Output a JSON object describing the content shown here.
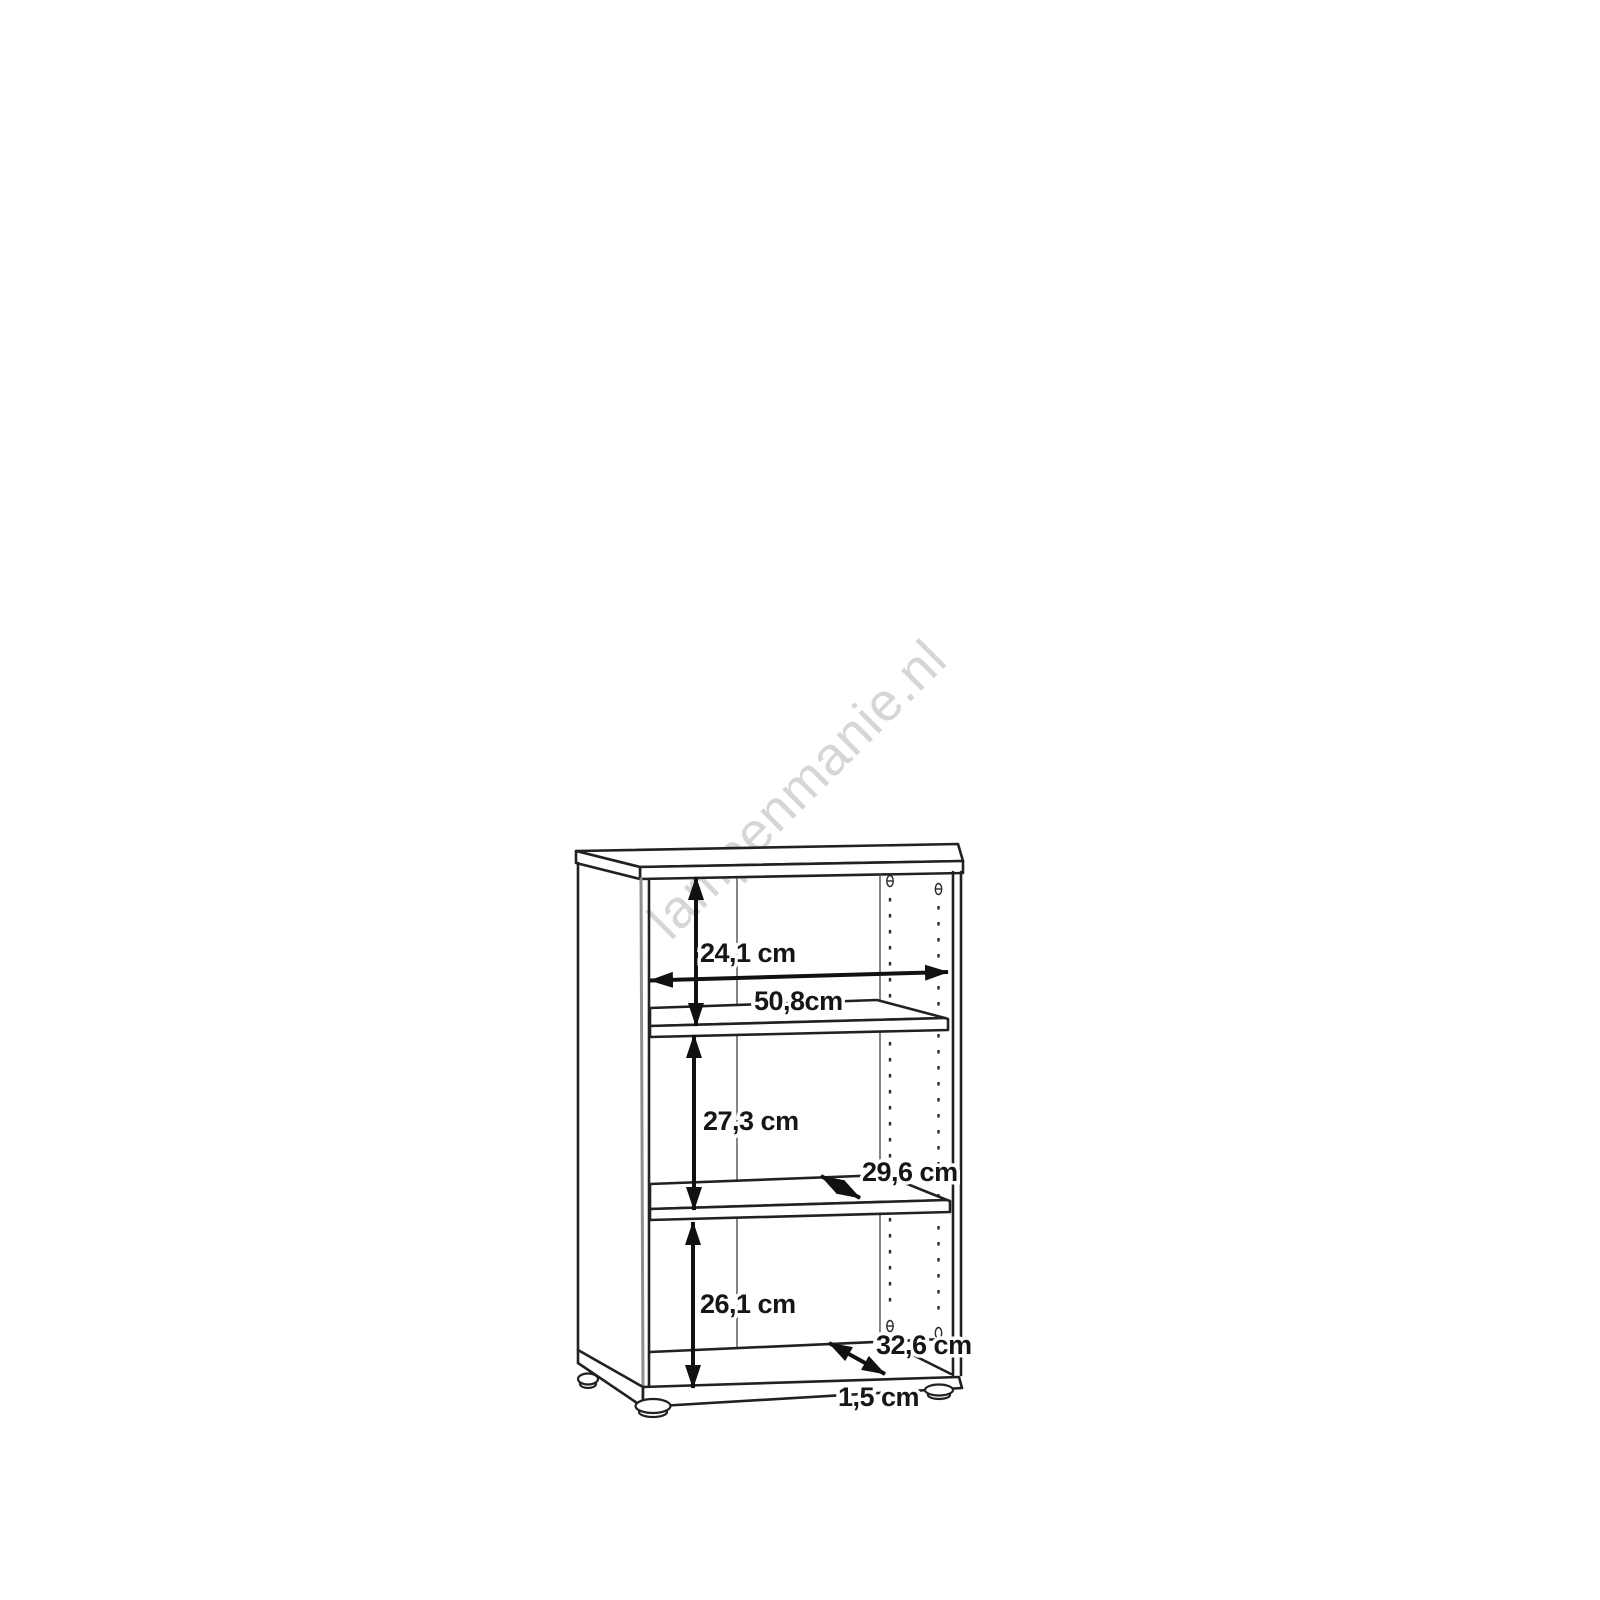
{
  "watermark": "lampenmanie.nl",
  "diagram": {
    "dimensions": {
      "top_section_height": "24,1 cm",
      "inner_width": "50,8cm",
      "middle_section_height": "27,3 cm",
      "shelf_depth": "29,6 cm",
      "bottom_section_height": "26,1 cm",
      "bottom_depth": "32,6 cm",
      "base_height": "1,5 cm"
    },
    "colors": {
      "outline": "#22211f",
      "arrow": "#111111",
      "watermark": "#d6d6d6",
      "background": "#ffffff"
    }
  }
}
